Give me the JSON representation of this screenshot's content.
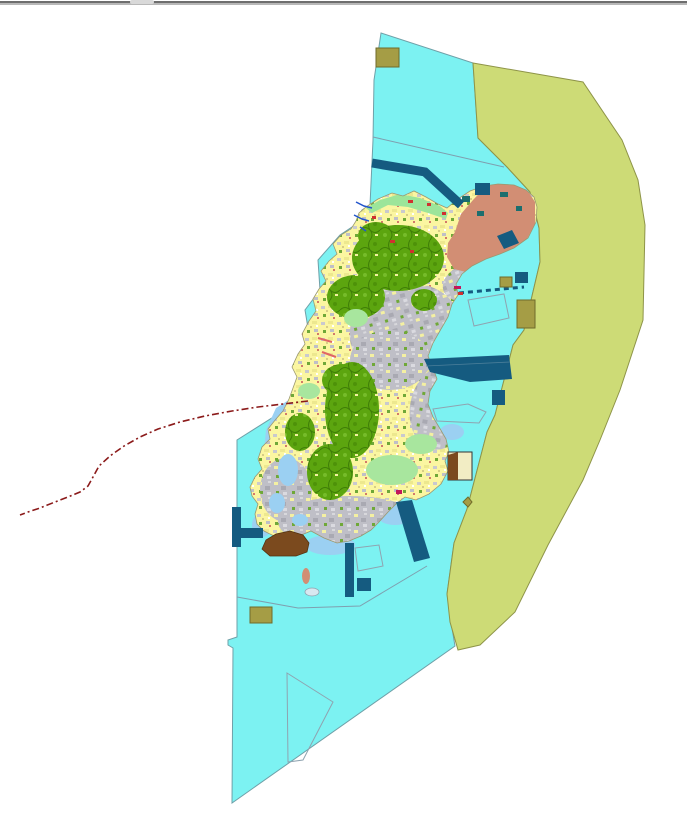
{
  "window": {
    "top_bar_color": "#6E6E6E",
    "top_bar_highlight": "#B8B8B8",
    "top_bar_tab_color": "#D9D9D9"
  },
  "map": {
    "background": "#FFFFFF",
    "palette": {
      "sea": "#7CF2F2",
      "sea_edge": "#6FA0A8",
      "outer_zone": "#CDDB76",
      "outer_zone_border": "#8E9448",
      "island_base": "#FBF6A1",
      "forest": "#5CA50F",
      "forest_border": "#3F7E07",
      "urban": "#BFBFC7",
      "meadow": "#A8E69E",
      "coastal_strip": "#9CE59A",
      "salmon_district": "#D28E74",
      "shallow_water": "#9BD0F2",
      "harbor_structure": "#155B80",
      "brown_site": "#7B4A1E",
      "brown_site_border": "#54330F",
      "khaki_site": "#A59D45",
      "khaki_site_border": "#6F6A2A",
      "boundary_line": "#7F9FAF",
      "island_outline": "#9A9870",
      "route_dashed_red": "#8B1A1A",
      "stream_blue": "#2255CC",
      "accent_red": "#D03030",
      "accent_magenta": "#C2185B",
      "teal_parcel": "#1C6E6E",
      "cream_panel": "#F2EDC4",
      "pale_blob": "#D8E8F0",
      "outline_poly_stroke": "#8FA3B0"
    }
  }
}
